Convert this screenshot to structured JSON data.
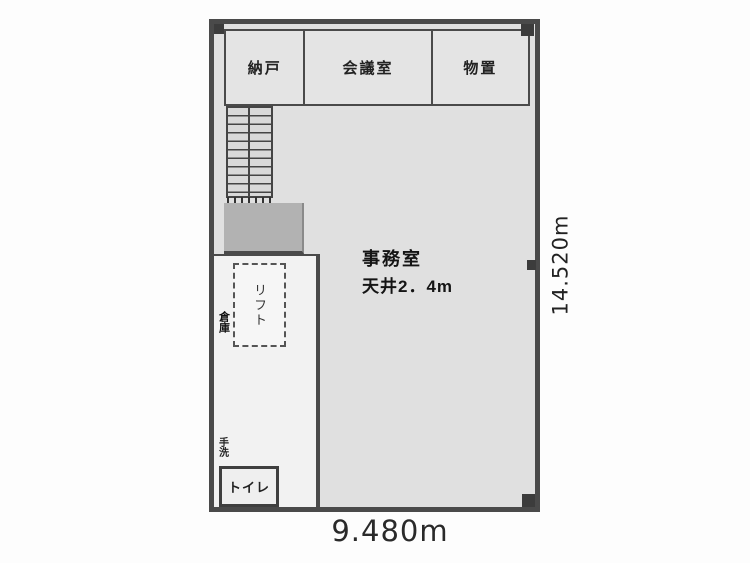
{
  "plan": {
    "title": "floor-plan",
    "top_rooms": [
      {
        "label": "納戸"
      },
      {
        "label": "会議室"
      },
      {
        "label": "物置"
      }
    ],
    "office": {
      "label": "事務室",
      "ceiling_note": "天井2．4m"
    },
    "lift": {
      "label": "リフト"
    },
    "side_storage": {
      "label": "倉庫"
    },
    "washstand": {
      "label": "手洗"
    },
    "toilet": {
      "label": "トイレ"
    },
    "dimensions": {
      "width": "9.480m",
      "height": "14.520m"
    },
    "colors": {
      "wall": "#4a4a4a",
      "office_fill": "#e0e0e0",
      "corridor_fill": "#f2f2f2",
      "landing_fill": "#b2b2b2",
      "background": "#fdfdfd"
    }
  }
}
